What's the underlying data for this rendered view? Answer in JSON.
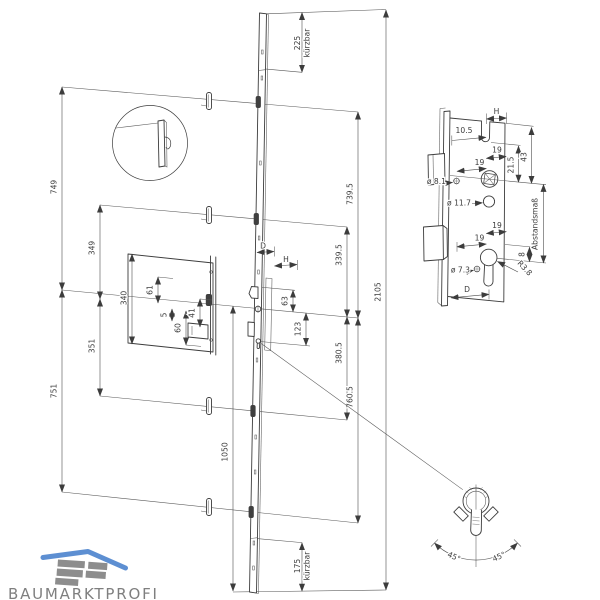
{
  "labels": {
    "left": {
      "d749": "749",
      "d751": "751",
      "d349": "349",
      "d351": "351",
      "d340": "340",
      "d61": "61",
      "d5": "5",
      "d60": "60",
      "d41": "41"
    },
    "center": {
      "shorten_top_value": "225",
      "shorten_top_word": "kürzbar",
      "d739_5": "739.5",
      "d339_5": "339.5",
      "backset": "D",
      "handle": "H",
      "d63": "63",
      "d123": "123",
      "d380_5": "380.5",
      "d760_5": "760.5",
      "d1050": "1050",
      "shorten_bottom_value": "175",
      "shorten_bottom_word": "kürzbar",
      "d2105": "2105"
    },
    "lock_detail": {
      "handle": "H",
      "d10_5": "10.5",
      "d19_top_a": "19",
      "d19_top_b": "19",
      "d21_5": "21.5",
      "d43": "43",
      "dia_8_1": "ø 8.1",
      "dia_11_7": "ø 11.7",
      "abstandsmass": "Abstandsmaß",
      "d19_bottom_a": "19",
      "d19_bottom_b": "19",
      "dia_7_3": "ø 7.3",
      "radius": "R3.8",
      "d8": "8",
      "backset": "D"
    },
    "cylinder_detail": {
      "angle_left": "45°",
      "angle_right": "45°"
    },
    "logo": {
      "name": "BAUMARKTPROFI"
    }
  }
}
